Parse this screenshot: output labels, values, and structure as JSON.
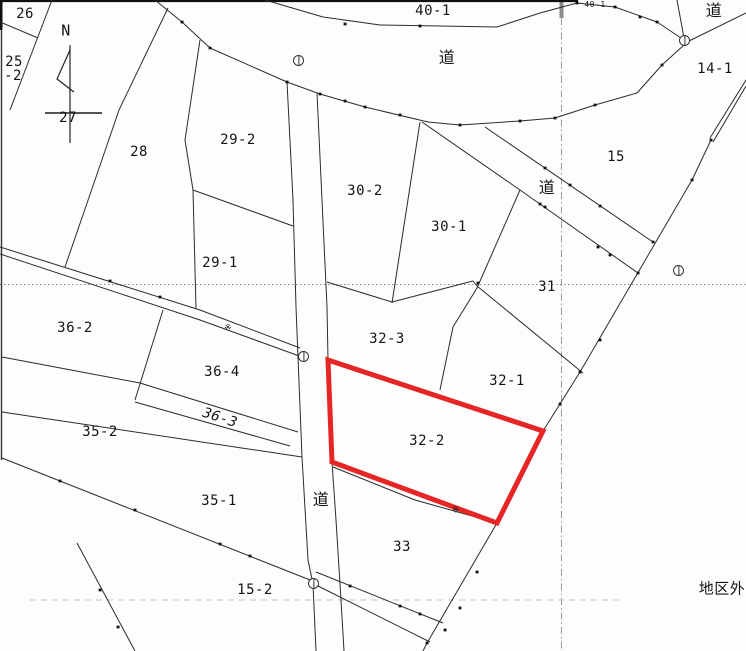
{
  "map": {
    "kind": "cadastral-parcel-map",
    "colors": {
      "boundary_line": "#2b2b2b",
      "grid_line": "#999999",
      "highlight_red": "#e62525"
    },
    "labels": [
      {
        "text": "26",
        "x": 25,
        "y": 14,
        "name": "parcel-label-26"
      },
      {
        "text": "25",
        "x": 14,
        "y": 62,
        "name": "parcel-label-25-2-line1"
      },
      {
        "text": "-2",
        "x": 13,
        "y": 76,
        "name": "parcel-label-25-2-line2"
      },
      {
        "text": "N",
        "x": 66,
        "y": 31,
        "fs": 15,
        "name": "compass-north-label"
      },
      {
        "text": "27",
        "x": 68,
        "y": 118,
        "name": "parcel-label-27"
      },
      {
        "text": "28",
        "x": 139,
        "y": 152,
        "name": "parcel-label-28"
      },
      {
        "text": "29-2",
        "x": 238,
        "y": 140,
        "name": "parcel-label-29-2"
      },
      {
        "text": "29-1",
        "x": 220,
        "y": 263,
        "name": "parcel-label-29-1"
      },
      {
        "text": "40-1",
        "x": 433,
        "y": 11,
        "name": "parcel-label-40-1"
      },
      {
        "text": "40-1",
        "x": 595,
        "y": 5,
        "fs": 8,
        "name": "parcel-label-40-1-small"
      },
      {
        "text": "道",
        "x": 447,
        "y": 58,
        "fs": 16,
        "name": "road-label-top"
      },
      {
        "text": "道",
        "x": 714,
        "y": 11,
        "fs": 16,
        "name": "road-label-top-right"
      },
      {
        "text": "14-1",
        "x": 715,
        "y": 69,
        "name": "parcel-label-14-1"
      },
      {
        "text": "15",
        "x": 616,
        "y": 157,
        "name": "parcel-label-15"
      },
      {
        "text": "道",
        "x": 547,
        "y": 188,
        "fs": 16,
        "name": "road-label-diagonal"
      },
      {
        "text": "30-2",
        "x": 365,
        "y": 191,
        "name": "parcel-label-30-2"
      },
      {
        "text": "30-1",
        "x": 449,
        "y": 227,
        "name": "parcel-label-30-1"
      },
      {
        "text": "31",
        "x": 547,
        "y": 287,
        "name": "parcel-label-31"
      },
      {
        "text": "36-2",
        "x": 75,
        "y": 328,
        "name": "parcel-label-36-2"
      },
      {
        "text": "32-3",
        "x": 387,
        "y": 339,
        "name": "parcel-label-32-3"
      },
      {
        "text": "36-4",
        "x": 222,
        "y": 372,
        "name": "parcel-label-36-4"
      },
      {
        "text": "32-1",
        "x": 507,
        "y": 381,
        "name": "parcel-label-32-1"
      },
      {
        "text": "36-3",
        "x": 220,
        "y": 418,
        "rot": 18,
        "cls": "slant",
        "name": "parcel-label-36-3"
      },
      {
        "text": "35-2",
        "x": 100,
        "y": 432,
        "name": "parcel-label-35-2"
      },
      {
        "text": "32-2",
        "x": 427,
        "y": 441,
        "name": "parcel-label-32-2"
      },
      {
        "text": "35-1",
        "x": 219,
        "y": 501,
        "name": "parcel-label-35-1"
      },
      {
        "text": "道",
        "x": 321,
        "y": 500,
        "fs": 16,
        "name": "road-label-vertical"
      },
      {
        "text": "33",
        "x": 402,
        "y": 547,
        "name": "parcel-label-33"
      },
      {
        "text": "15-2",
        "x": 255,
        "y": 590,
        "name": "parcel-label-15-2"
      },
      {
        "text": "地区外",
        "x": 722,
        "y": 589,
        "fs": 15,
        "name": "outside-district-label"
      },
      {
        "text": "※",
        "x": 228,
        "y": 329,
        "fs": 9,
        "name": "reference-marker-1"
      },
      {
        "text": "※",
        "x": 456,
        "y": 511,
        "fs": 9,
        "name": "reference-marker-2"
      }
    ],
    "symbols": [
      {
        "x": 299,
        "y": 61
      },
      {
        "x": 685,
        "y": 41
      },
      {
        "x": 679,
        "y": 271
      },
      {
        "x": 304,
        "y": 357
      },
      {
        "x": 314,
        "y": 584
      }
    ],
    "highlight": {
      "parcel": "32-2",
      "color": "#e62525",
      "stroke_width": 5,
      "points": "328,360 543,431 497,523 332,462"
    }
  }
}
